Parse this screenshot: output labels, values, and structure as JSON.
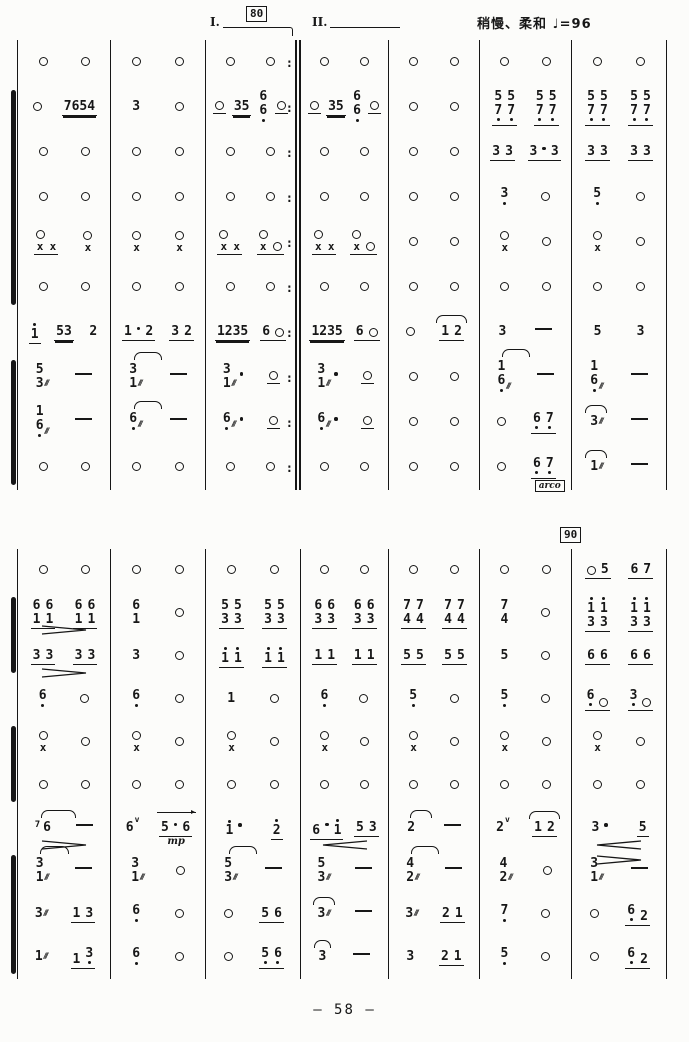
{
  "annotations": {
    "rehearsal_top": "80",
    "rehearsal_bottom": "90",
    "volta1": "I.",
    "volta2": "II.",
    "tempo": "稍慢、柔和 ♩=96",
    "page_number": "— 58 —"
  },
  "labels": {
    "mp": "mp",
    "arco": "arco",
    "repeat_dots": ":",
    "tremolo": "///"
  },
  "systems": [
    {
      "repeat_col": 2,
      "brackets": [
        [
          2,
          6
        ],
        [
          8,
          10
        ]
      ],
      "rows": [
        [
          [
            "O",
            "O"
          ],
          [
            "O",
            "O"
          ],
          [
            "O",
            "O"
          ],
          [
            "O",
            "O"
          ],
          [
            "O",
            "O"
          ],
          [
            "O",
            "O"
          ],
          [
            "O",
            "O"
          ]
        ],
        [
          [
            "O",
            "7654|2"
          ],
          [
            "3",
            "O"
          ],
          [
            "O|1",
            "35|2",
            "6/6,",
            "O|1"
          ],
          [
            "O|1",
            "35|2",
            "6/6,",
            "O|1"
          ],
          [
            "O",
            "O"
          ],
          [
            "5/7, 5/7,|1",
            "5/7, 5/7,|1"
          ],
          [
            "5/7, 5/7,|1",
            "5/7, 5/7,|1"
          ]
        ],
        [
          [
            "O",
            "O"
          ],
          [
            "O",
            "O"
          ],
          [
            "O",
            "O"
          ],
          [
            "O",
            "O"
          ],
          [
            "O",
            "O"
          ],
          [
            "3 3|1",
            "3 . 3|1"
          ],
          [
            "3 3|1",
            "3 3|1"
          ]
        ],
        [
          [
            "O",
            "O"
          ],
          [
            "O",
            "O"
          ],
          [
            "O",
            "O"
          ],
          [
            "O",
            "O"
          ],
          [
            "O",
            "O"
          ],
          [
            "3,",
            "O"
          ],
          [
            "5,",
            "O"
          ]
        ],
        [
          [
            "O/x x|1",
            "O/x"
          ],
          [
            "O/x",
            "O/x"
          ],
          [
            "O/x x|1",
            "O/x O|1"
          ],
          [
            "O/x x|1",
            "O/x O|1"
          ],
          [
            "O",
            "O"
          ],
          [
            "O/x",
            "O"
          ],
          [
            "O/x",
            "O"
          ]
        ],
        [
          [
            "O",
            "O"
          ],
          [
            "O",
            "O"
          ],
          [
            "O",
            "O"
          ],
          [
            "O",
            "O"
          ],
          [
            "O",
            "O"
          ],
          [
            "O",
            "O"
          ],
          [
            "O",
            "O"
          ]
        ],
        [
          [
            "1'|1",
            "53|2",
            "2"
          ],
          [
            "1 . 2|1",
            "3 2|1"
          ],
          [
            "1235|2",
            "6 O|1"
          ],
          [
            "1235|2",
            "6 O|1"
          ],
          [
            "O",
            "1 2|1|arc"
          ],
          [
            "3",
            "-"
          ],
          [
            "5",
            "3"
          ]
        ],
        [
          [
            "5/3~",
            "-"
          ],
          [
            "3/1~|0|tie",
            "-"
          ],
          [
            "3/1~ .",
            "O|1"
          ],
          [
            "3/1~ .",
            "O|1"
          ],
          [
            "O",
            "O"
          ],
          [
            "1/6,~|0|tie",
            "-"
          ],
          [
            "1/6,~",
            "-"
          ]
        ],
        [
          [
            "1/6,~",
            "-"
          ],
          [
            "6,~|0|tie",
            "-"
          ],
          [
            "6,~ .",
            "O|1"
          ],
          [
            "6,~ .",
            "O|1"
          ],
          [
            "O",
            "O"
          ],
          [
            "O",
            "6, 7,|1"
          ],
          [
            "3~|0|arc",
            "-"
          ]
        ],
        [
          [
            "O",
            "O"
          ],
          [
            "O",
            "O"
          ],
          [
            "O",
            "O"
          ],
          [
            "O",
            "O"
          ],
          [
            "O",
            "O"
          ],
          [
            "O",
            "6, 7,|1|arco"
          ],
          [
            "1~|0|arc",
            "-"
          ]
        ]
      ]
    },
    {
      "repeat_col": -1,
      "brackets": [
        [
          2,
          3
        ],
        [
          5,
          6
        ],
        [
          8,
          10
        ]
      ],
      "rows": [
        [
          [
            "O",
            "O"
          ],
          [
            "O",
            "O"
          ],
          [
            "O",
            "O"
          ],
          [
            "O",
            "O"
          ],
          [
            "O",
            "O"
          ],
          [
            "O",
            "O"
          ],
          [
            "O 5|1",
            "6 7|1"
          ]
        ],
        [
          [
            "6/1 6/1|1|hp>",
            "6/1 6/1|1"
          ],
          [
            "6/1",
            "O"
          ],
          [
            "5/3 5/3|1",
            "5/3 5/3|1"
          ],
          [
            "6/3 6/3|1",
            "6/3 6/3|1"
          ],
          [
            "7/4 7/4|1",
            "7/4 7/4|1"
          ],
          [
            "7/4",
            "O"
          ],
          [
            "1'/3 1'/3|1",
            "1'/3 1'/3|1"
          ]
        ],
        [
          [
            "3 3|1|hp>",
            "3 3|1"
          ],
          [
            "3",
            "O"
          ],
          [
            "1' 1'|1",
            "1' 1'|1"
          ],
          [
            "1 1|1",
            "1 1|1"
          ],
          [
            "5 5|1",
            "5 5|1"
          ],
          [
            "5",
            "O"
          ],
          [
            "6 6|1",
            "6 6|1"
          ]
        ],
        [
          [
            "6,",
            "O"
          ],
          [
            "6,",
            "O"
          ],
          [
            "1",
            "O"
          ],
          [
            "6,",
            "O"
          ],
          [
            "5,",
            "O"
          ],
          [
            "5,",
            "O"
          ],
          [
            "6, O|1",
            "3, O|1"
          ]
        ],
        [
          [
            "O/x",
            "O"
          ],
          [
            "O/x",
            "O"
          ],
          [
            "O/x",
            "O"
          ],
          [
            "O/x",
            "O"
          ],
          [
            "O/x",
            "O"
          ],
          [
            "O/x",
            "O"
          ],
          [
            "O/x",
            "O"
          ]
        ],
        [
          [
            "O",
            "O"
          ],
          [
            "O",
            "O"
          ],
          [
            "O",
            "O"
          ],
          [
            "O",
            "O"
          ],
          [
            "O",
            "O"
          ],
          [
            "O",
            "O"
          ],
          [
            "O",
            "O"
          ]
        ],
        [
          [
            "(7) 6|0|tie,hp>",
            "-"
          ],
          [
            "6v",
            "5 . 6|1|bar,mp"
          ],
          [
            "1' .",
            "2'|1"
          ],
          [
            "6 . 1'|1|hp<",
            "5 3|1"
          ],
          [
            "2|0|tie",
            "-"
          ],
          [
            "2v",
            "1 2|1|arc"
          ],
          [
            "3 .|0|hp<",
            "5|1"
          ]
        ],
        [
          [
            "3/1~|0|tie",
            "-"
          ],
          [
            "3/1~",
            "O"
          ],
          [
            "5/3~|0|tie",
            "-"
          ],
          [
            "5/3~",
            "-"
          ],
          [
            "4/2~|0|tie",
            "-"
          ],
          [
            "4/2~",
            "O"
          ],
          [
            "3/1~|0|hpa>",
            "-"
          ]
        ],
        [
          [
            "3~",
            "1 3|1"
          ],
          [
            "6,",
            "O"
          ],
          [
            "O",
            "5 6|1"
          ],
          [
            "3~|0|arc",
            "-"
          ],
          [
            "3~",
            "2 1|1"
          ],
          [
            "7,",
            "O"
          ],
          [
            "O",
            "6, 2|1"
          ]
        ],
        [
          [
            "1~",
            "1 3,|1"
          ],
          [
            "6,",
            "O"
          ],
          [
            "O",
            "5, 6,|1"
          ],
          [
            "3|0|arc",
            "-"
          ],
          [
            "3",
            "2 1|1"
          ],
          [
            "5,",
            "O"
          ],
          [
            "O",
            "6, 2|1"
          ]
        ]
      ]
    }
  ]
}
